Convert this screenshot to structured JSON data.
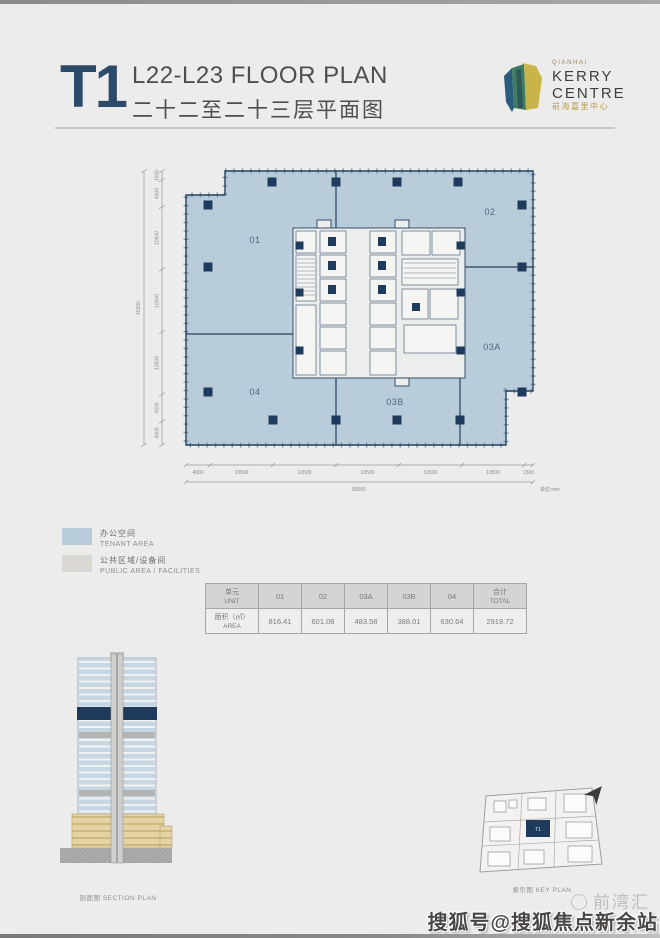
{
  "header": {
    "tower": "T1",
    "title_en": "L22-L23 FLOOR PLAN",
    "title_cn": "二十二至二十三层平面图"
  },
  "logo": {
    "qianhai": "QIANHAI",
    "kerry": "KERRY",
    "centre": "CENTRE",
    "cn": "前海嘉里中心"
  },
  "plan": {
    "units": {
      "u01": "01",
      "u02": "02",
      "u03a": "03A",
      "u03b": "03B",
      "u04": "04"
    },
    "dims_left": [
      "1500",
      "4500",
      "10500",
      "10500",
      "10500",
      "4500",
      "4000"
    ],
    "dims_left_total": "46200",
    "dims_bottom": [
      "4000",
      "10500",
      "10500",
      "10500",
      "10500",
      "10500",
      "1500"
    ],
    "dims_bottom_total": "58000",
    "unit_note": "单位:mm"
  },
  "legend": {
    "items": [
      {
        "cn": "办公空间",
        "en": "TENANT AREA",
        "color": "#b9ccd9"
      },
      {
        "cn": "公共区域/设备间",
        "en": "PUBLIC AREA / FACILITIES",
        "color": "#dbd8d3"
      }
    ]
  },
  "area_table": {
    "unit_cn": "单元",
    "unit_en": "UNIT",
    "area_cn": "面积（㎡）",
    "area_en": "AREA",
    "total_cn": "合计",
    "total_en": "TOTAL",
    "columns": [
      "01",
      "02",
      "03A",
      "03B",
      "04"
    ],
    "values": [
      "816.41",
      "601.08",
      "483.58",
      "388.01",
      "630.64"
    ],
    "total_value": "2919.72"
  },
  "section": {
    "caption_cn": "剖面图",
    "caption_en": "SECTION PLAN"
  },
  "keyplan": {
    "caption_cn": "索引图",
    "caption_en": "KEY PLAN",
    "tower": "T1"
  },
  "watermarks": {
    "brand": "前湾汇",
    "sohu": "搜狐号@搜狐焦点新余站"
  },
  "colors": {
    "navy": "#1e3a5c",
    "plan_fill": "#b9ccd9",
    "core_fill": "#eceded",
    "podium_beige": "#e4d4a4",
    "page_bg": "#edecec",
    "tower_navy_text": "#2c4a6a",
    "gold": "#b59b4e"
  }
}
